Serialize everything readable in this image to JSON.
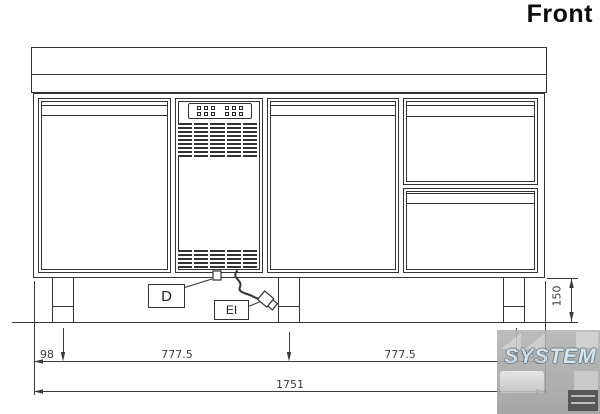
{
  "title": "Front",
  "callouts": {
    "drain_label": "D",
    "electric_label": "EI"
  },
  "dimensions": {
    "left_offset": "98",
    "left_span": "777.5",
    "right_span": "777.5",
    "right_offset": "98",
    "total_width": "1751",
    "leg_height": "150"
  },
  "watermark": {
    "brand": "SYSTEM"
  },
  "colors": {
    "line": "#333333",
    "dim": "#3c3c3c",
    "watermark-bg": "#a6a6a6",
    "watermark-text": "#cfe4ef"
  }
}
